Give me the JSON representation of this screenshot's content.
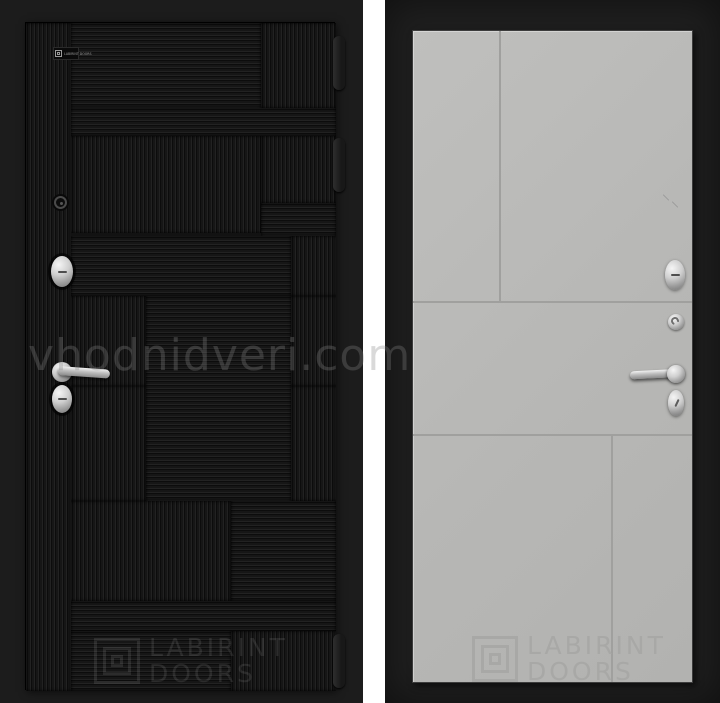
{
  "watermark": {
    "text": "vhodnidveri.com"
  },
  "brand": {
    "line1": "LABIRINT",
    "line2": "DOORS"
  },
  "left_door": {
    "side": "front",
    "finish_color": "#121212",
    "badge": {
      "line1": "LABIRINT",
      "line2": "DOORS"
    },
    "logo": {
      "line1": "LABIRINT",
      "line2": "DOORS"
    }
  },
  "right_door": {
    "side": "back",
    "finish_color": "#b8b8b6",
    "logo": {
      "line1": "LABIRINT",
      "line2": "DOORS"
    }
  },
  "colors": {
    "left_background": "#1c1c1c",
    "frame": "#1f1f1f",
    "panel_line": "#a0a09e",
    "hardware_silver": "#c9c9c9"
  }
}
